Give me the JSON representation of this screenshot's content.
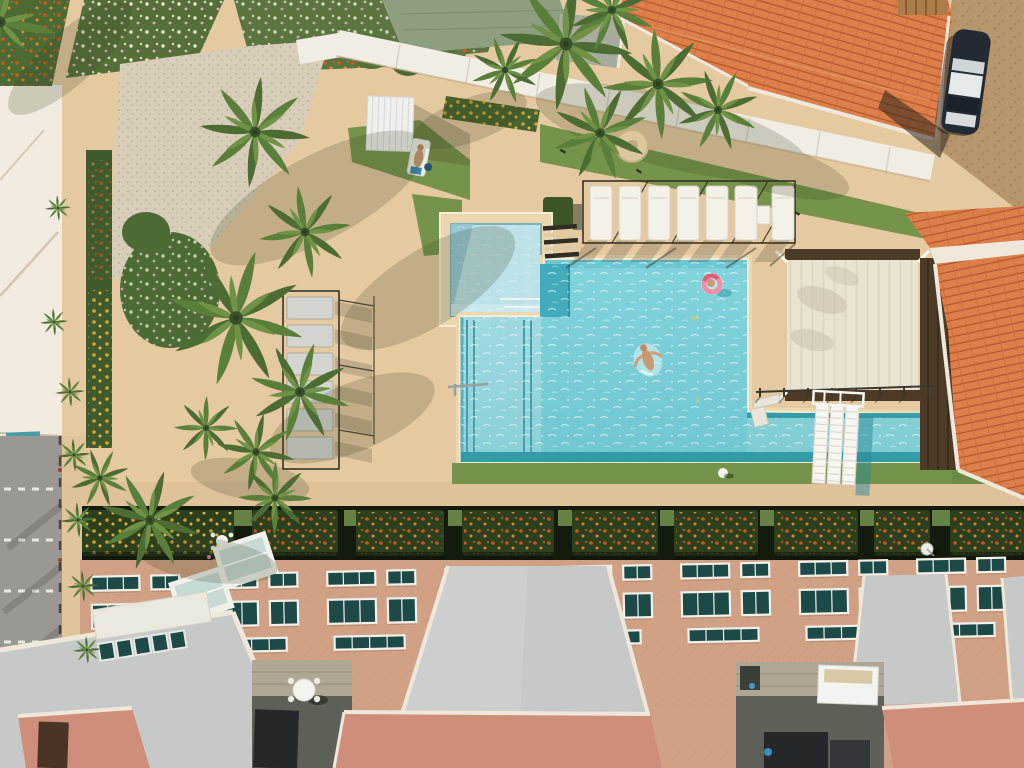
{
  "scene": {
    "setting": "aerial-top-down-resort-pool",
    "swimmers_in_pool": 2,
    "sunbathers": 1,
    "sun_loungers_poolside_row": 7,
    "stacked_loungers_garden_column": 6,
    "parked_cars": 1,
    "pools": 2,
    "satellite_dishes": 1
  },
  "palette": {
    "sand": "#e5c9a1",
    "sandLight": "#eed9b4",
    "walkway": "#dfc19a",
    "pebble": "#d8cdb8",
    "whiteSand": "#f2ebdf",
    "road": "#9b9894",
    "roadDash": "#eae8e0",
    "dirt": "#b6966d",
    "poolMain": "#82d3dc",
    "poolLane": "#a9dee4",
    "poolRight": "#98dade",
    "poolDark": "#2d97a2",
    "poolSteps": "#41abbc",
    "kidsPool": "#bce1e6",
    "coping": "#f5ebd1",
    "deckRing": "#ecd8b0",
    "grass": "#75934a",
    "grassBright": "#82a455",
    "hedge": "#2c401d",
    "hedgeBase": "#121b0d",
    "flowerOrange": "#cf5c22",
    "flowerYellow": "#dfab2b",
    "bloomWhite": "#f3ead8",
    "bloomPink": "#e5b8c6",
    "palmDark": "#4c6c33",
    "palmMid": "#5a7f3b",
    "palmLight": "#6f9247",
    "shadow": "#3a4124",
    "roofOrange": "#dd7f48",
    "roofTileLine": "#b5562e",
    "ridge": "#efe8da",
    "sage": "#8e9e80",
    "grayPad": "#a7ab9c",
    "wallWhite": "#f1ede3",
    "canopy": "#e9e3d2",
    "wood": "#4b3b27",
    "woodPergola": "#ab7d4b",
    "carBody": "#222b33",
    "carRoof": "#e6e9ea",
    "facade": "#d0a184",
    "facadeLight": "#dcb294",
    "windowTeal": "#1d4946",
    "frame": "#f2f0ea",
    "roofGray": "#c7c9c8",
    "roofGrayLight": "#d5d7d6",
    "salmon": "#cf8e7a",
    "brick": "#afa795",
    "patioFloor": "#5d6057",
    "couch": "#25282a",
    "tableWhite": "#f3f3ef",
    "floatPink": "#ee8fa4",
    "floatDeep": "#df5d7b",
    "skin": "#c79a74",
    "glassTeal": "#c3d7d2"
  }
}
